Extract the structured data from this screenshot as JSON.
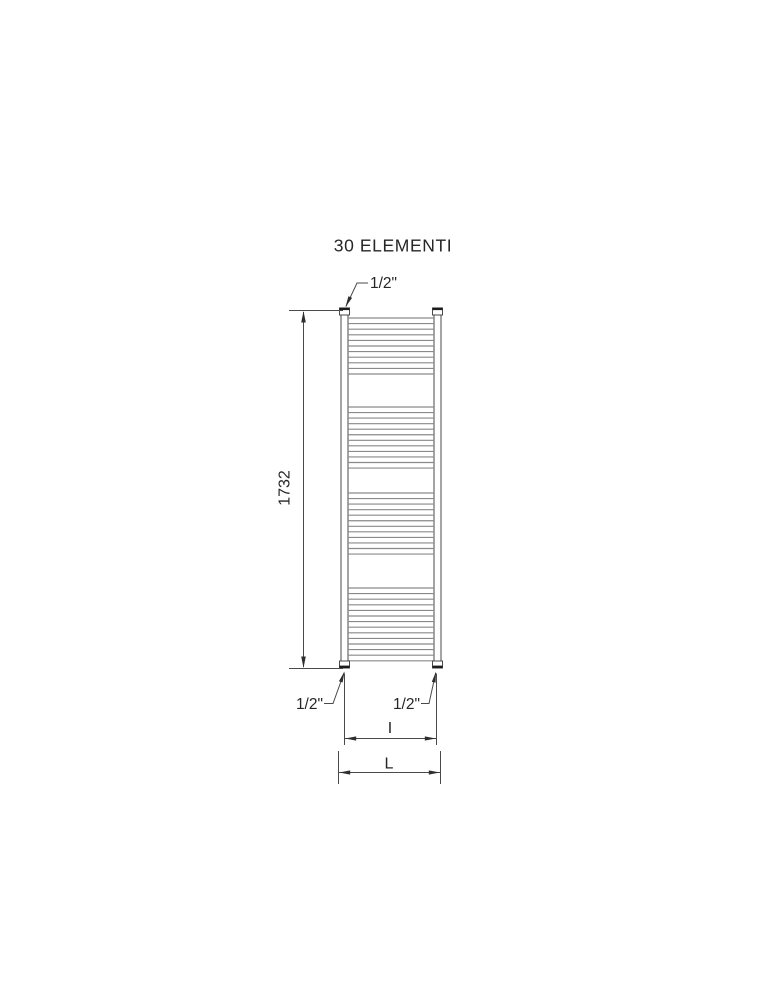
{
  "title": "30 ELEMENTI",
  "drawing": {
    "type": "technical-diagram",
    "subject": "towel-rail radiator front elevation",
    "elements_label_count": 30,
    "radiator": {
      "tube_groups": [
        11,
        12,
        12,
        14
      ]
    }
  },
  "dimensions": {
    "height": "1732",
    "top_connection": "1/2\"",
    "bottom_left_connection": "1/2\"",
    "bottom_right_connection": "1/2\"",
    "inner_width_label": "I",
    "outer_width_label": "L"
  },
  "colors": {
    "background": "#ffffff",
    "line": "#4a4a4a",
    "tube": "#8a8a8a",
    "cap_dark": "#1c1c1c",
    "text": "#262626"
  }
}
